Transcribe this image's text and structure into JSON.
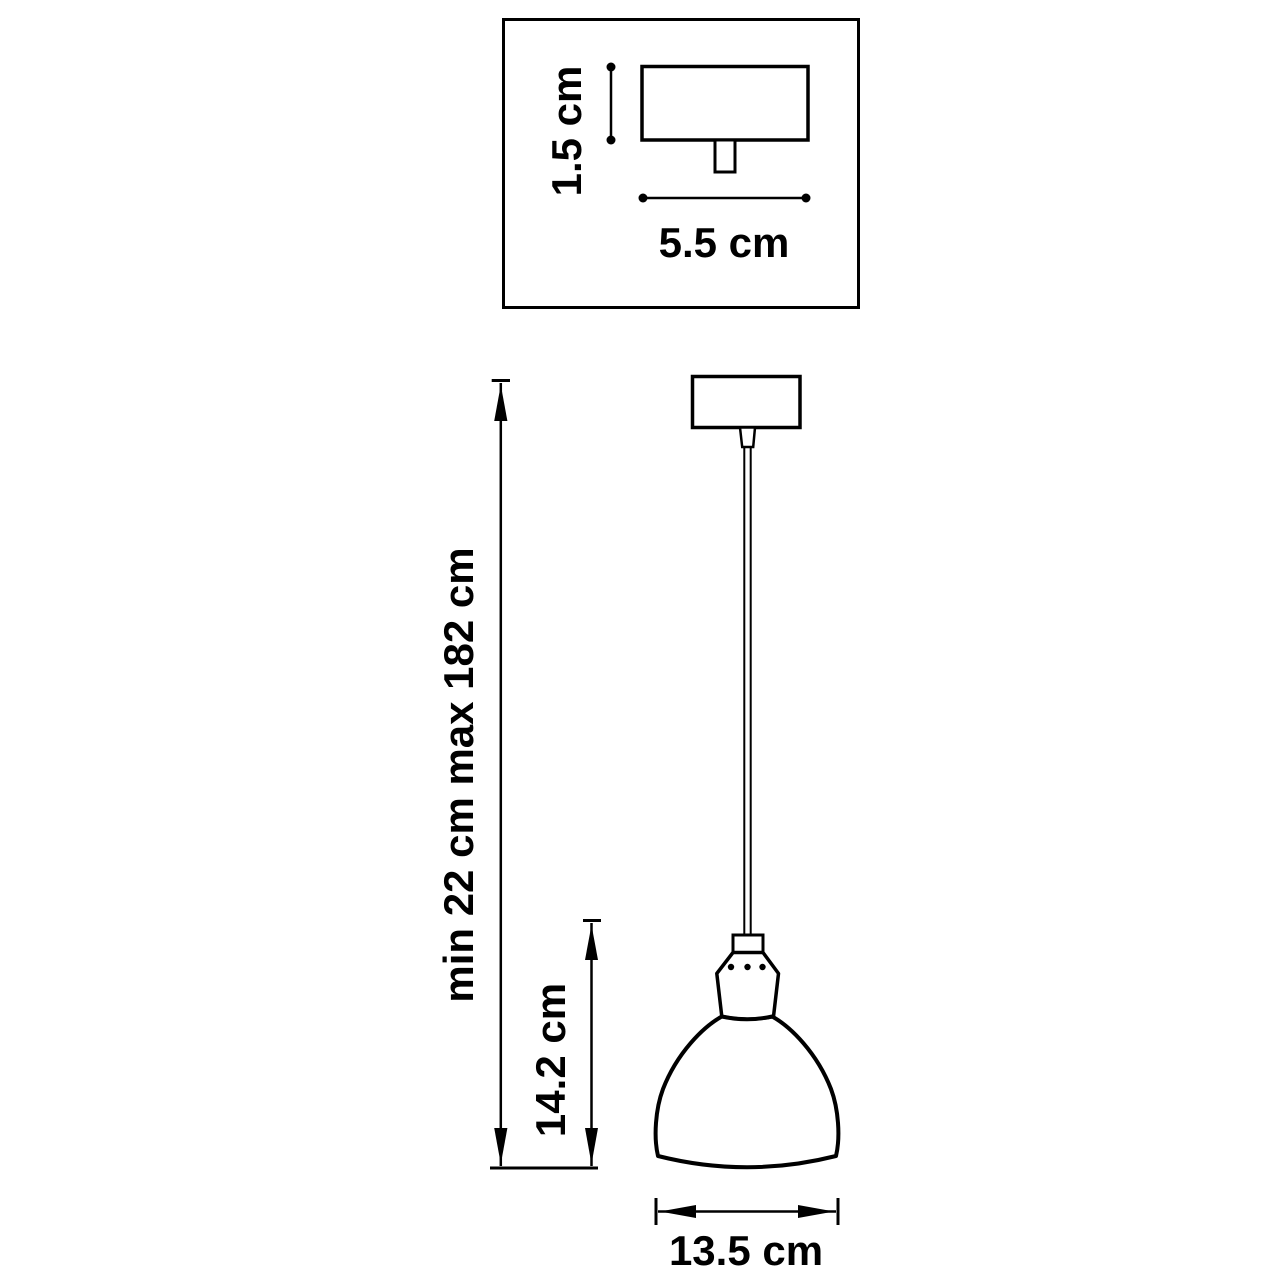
{
  "colors": {
    "line": "#000000",
    "background": "#ffffff"
  },
  "top_view": {
    "height_label": "1.5 cm",
    "width_label": "5.5 cm"
  },
  "front_view": {
    "suspension_height_label": "min 22 cm max 182 cm",
    "shade_height_label": "14.2 cm",
    "shade_width_label": "13.5 cm"
  }
}
